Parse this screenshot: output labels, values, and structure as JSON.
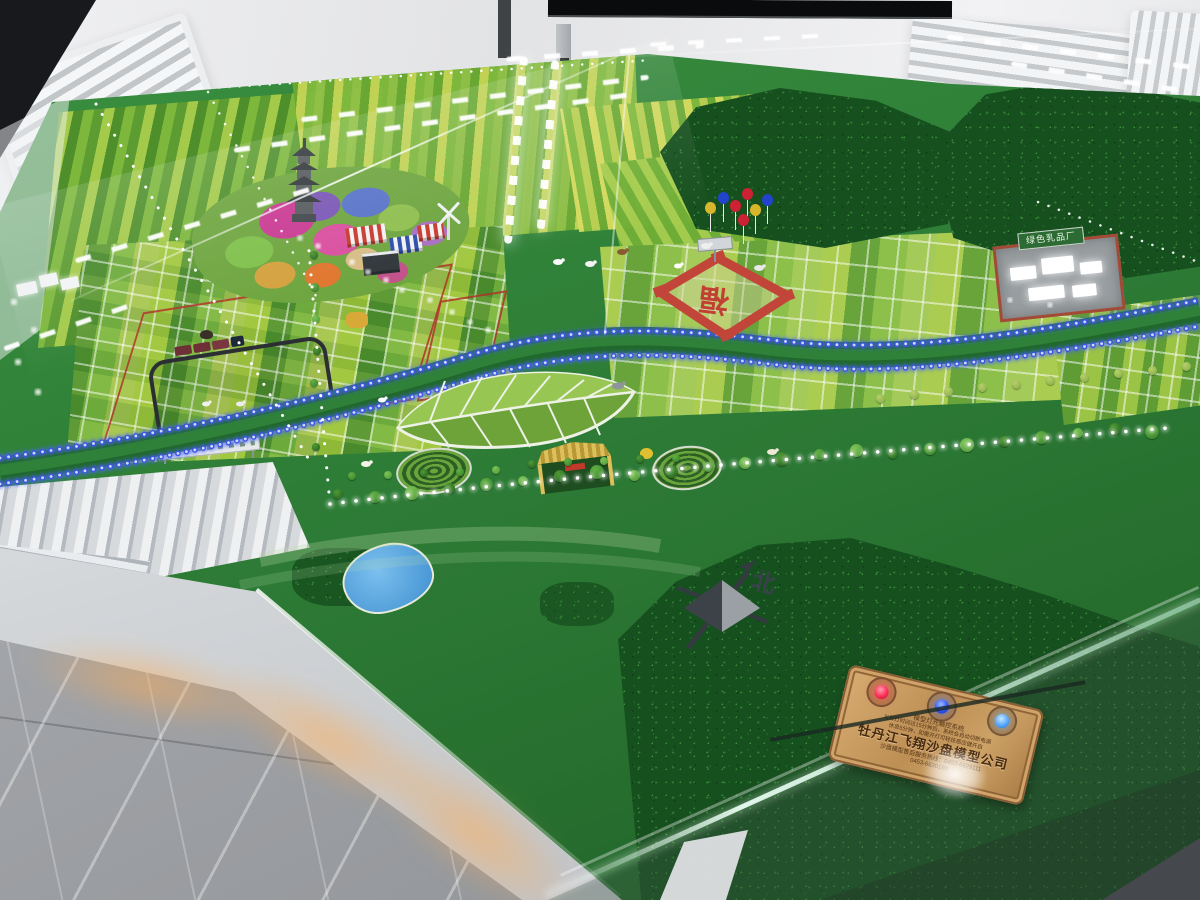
{
  "scene": {
    "type": "photograph",
    "subject": "Illuminated agricultural-park sand table scale model inside a glass display case",
    "setting": "Showroom with white walls, louvered air vents, wall-mounted screen and grey marble floor"
  },
  "model": {
    "dairy_factory_sign": "绿色乳品厂",
    "fortune_character": "福",
    "compass_north_label": "北"
  },
  "plaque": {
    "system_title": "模型灯光触控系统",
    "notice_line1": "当开灯时间达15分钟后，系统会自动切断电源",
    "notice_line2": "休息5分钟，如需开灯可轻抚感应键开启",
    "company_name": "牡丹江飞翔沙盘模型公司",
    "hotline_line1": "沙盘模型售后服务热线：0453-6629111",
    "hotline_line2": "0453-6630198",
    "buttons": [
      {
        "name": "red-touch-button",
        "color": "#ff2d55"
      },
      {
        "name": "blue-touch-button",
        "color": "#2d55ff"
      },
      {
        "name": "light-blue-touch-button",
        "color": "#57a8ff"
      }
    ]
  },
  "colors": {
    "felt_green": "#2e7d37",
    "forest_green": "#17501f",
    "river_led_blue": "#3b55e0",
    "path_led_white": "#ffffff",
    "plaque_copper": "#bd8f55",
    "accent_red": "#c2453a"
  }
}
